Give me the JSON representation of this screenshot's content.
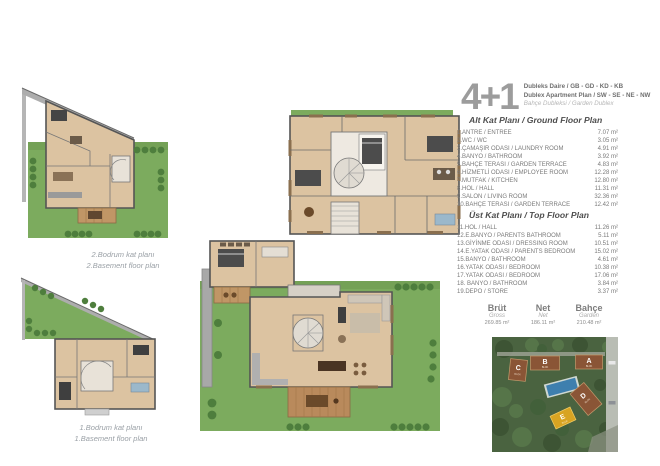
{
  "header": {
    "unit_type": "4+1",
    "line1": "Dubleks Daire / GB - GD - KD - KB",
    "line2": "Dublex Apartment Plan / SW - SE - NE - NW",
    "line3": "Bahçe Dubleksi / Garden Dublex"
  },
  "captions": {
    "basement2_tr": "2.Bodrum kat planı",
    "basement2_en": "2.Basement floor plan",
    "basement1_tr": "1.Bodrum kat planı",
    "basement1_en": "1.Basement floor plan"
  },
  "ground_floor": {
    "heading": "Alt Kat Planı / Ground Floor Plan",
    "rooms": [
      {
        "label": "1.ANTRE / ENTREE",
        "area": "7.07 m²"
      },
      {
        "label": "2.WC / WC",
        "area": "3.05 m²"
      },
      {
        "label": "3.ÇAMAŞIR ODASI / LAUNDRY ROOM",
        "area": "4.91 m²"
      },
      {
        "label": "4.BANYO / BATHROOM",
        "area": "3.92 m²"
      },
      {
        "label": "5.BAHÇE TERASI / GARDEN TERRACE",
        "area": "4.83 m²"
      },
      {
        "label": "6.HİZMETLİ ODASI / EMPLOYEE ROOM",
        "area": "12.28 m²"
      },
      {
        "label": "7.MUTFAK / KITCHEN",
        "area": "12.80 m²"
      },
      {
        "label": "8.HOL / HALL",
        "area": "11.31 m²"
      },
      {
        "label": "9.SALON / LIVING ROOM",
        "area": "32.36 m²"
      },
      {
        "label": "10.BAHÇE TERASI / GARDEN TERRACE",
        "area": "12.42 m²"
      }
    ]
  },
  "top_floor": {
    "heading": "Üst Kat Planı / Top Floor Plan",
    "rooms": [
      {
        "label": "11.HOL / HALL",
        "area": "11.26 m²"
      },
      {
        "label": "12.E.BANYO / PARENTS BATHROOM",
        "area": "5.11 m²"
      },
      {
        "label": "13.GİYİNME ODASI / DRESSING ROOM",
        "area": "10.51 m²"
      },
      {
        "label": "14.E.YATAK ODASI / PARENTS BEDROOM",
        "area": "15.02 m²"
      },
      {
        "label": "15.BANYO / BATHROOM",
        "area": "4.61 m²"
      },
      {
        "label": "16.YATAK ODASI / BEDROOM",
        "area": "10.38 m²"
      },
      {
        "label": "17.YATAK ODASI / BEDROOM",
        "area": "17.06 m²"
      },
      {
        "label": "18. BANYO / BATHROOM",
        "area": "3.84 m²"
      },
      {
        "label": "19.DEPO / STORE",
        "area": "3.37 m²"
      }
    ]
  },
  "totals": [
    {
      "label": "Brüt",
      "sublabel": "Gross",
      "value": "269.85 m²"
    },
    {
      "label": "Net",
      "sublabel": "Net",
      "value": "186.11 m²"
    },
    {
      "label": "Bahçe",
      "sublabel": "Garden",
      "value": "210.48 m²"
    }
  ],
  "site_plan": {
    "blocks": [
      {
        "letter": "A",
        "sub": "BLOK"
      },
      {
        "letter": "B",
        "sub": "BLOK"
      },
      {
        "letter": "C",
        "sub": "BLOK"
      },
      {
        "letter": "D",
        "sub": "BLOK"
      },
      {
        "letter": "E",
        "sub": "BLOK"
      }
    ]
  },
  "colors": {
    "grass": "#7cab5e",
    "bush": "#4e7e3d",
    "wood_floor": "#dcc3a1",
    "deck_wood": "#c09666",
    "wall_gray": "#555555",
    "site_green": "#4a6340",
    "block_brown": "#8a5536",
    "block_highlight": "#d8a422",
    "pool_blue": "#3e7fae",
    "text_gray": "#7a7a7a"
  }
}
